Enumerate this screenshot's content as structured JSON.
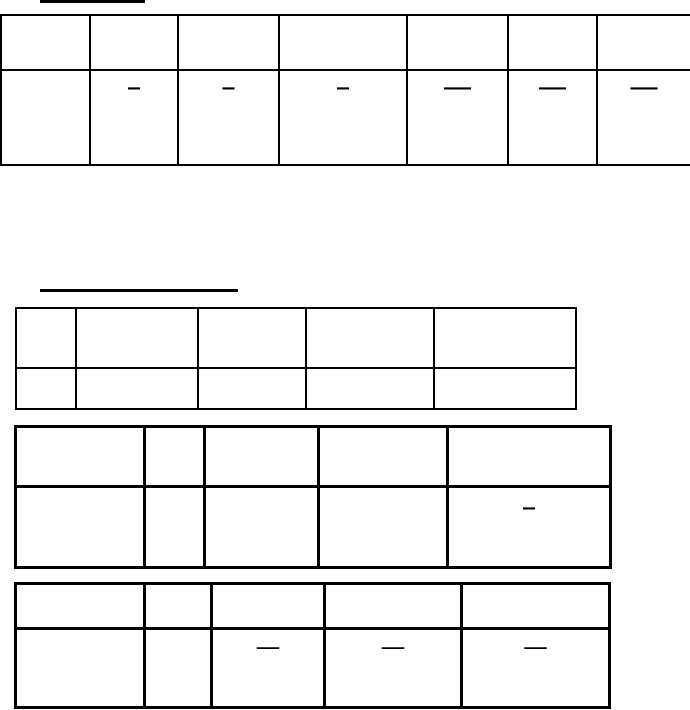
{
  "page": {
    "background_color": "#ffffff",
    "line_color": "#000000"
  },
  "headings": [
    {
      "text": ""
    },
    {
      "text": ""
    }
  ],
  "tables": [
    {
      "rows": [
        {
          "cells": [
            "",
            "",
            "",
            "",
            "",
            "",
            ""
          ]
        },
        {
          "cells": [
            "",
            "–",
            "–",
            "–",
            "—",
            "—",
            "—"
          ]
        }
      ]
    },
    {
      "rows": [
        {
          "cells": [
            "",
            "",
            "",
            "",
            ""
          ]
        },
        {
          "cells": [
            "",
            "",
            "",
            "",
            ""
          ]
        }
      ]
    },
    {
      "rows": [
        {
          "cells": [
            "",
            "",
            "",
            "",
            ""
          ]
        },
        {
          "cells": [
            "",
            "",
            "",
            "",
            "–"
          ]
        }
      ]
    },
    {
      "rows": [
        {
          "cells": [
            "",
            "",
            "",
            "",
            ""
          ]
        },
        {
          "cells": [
            "",
            "",
            "—",
            "—",
            "—"
          ]
        }
      ]
    }
  ]
}
